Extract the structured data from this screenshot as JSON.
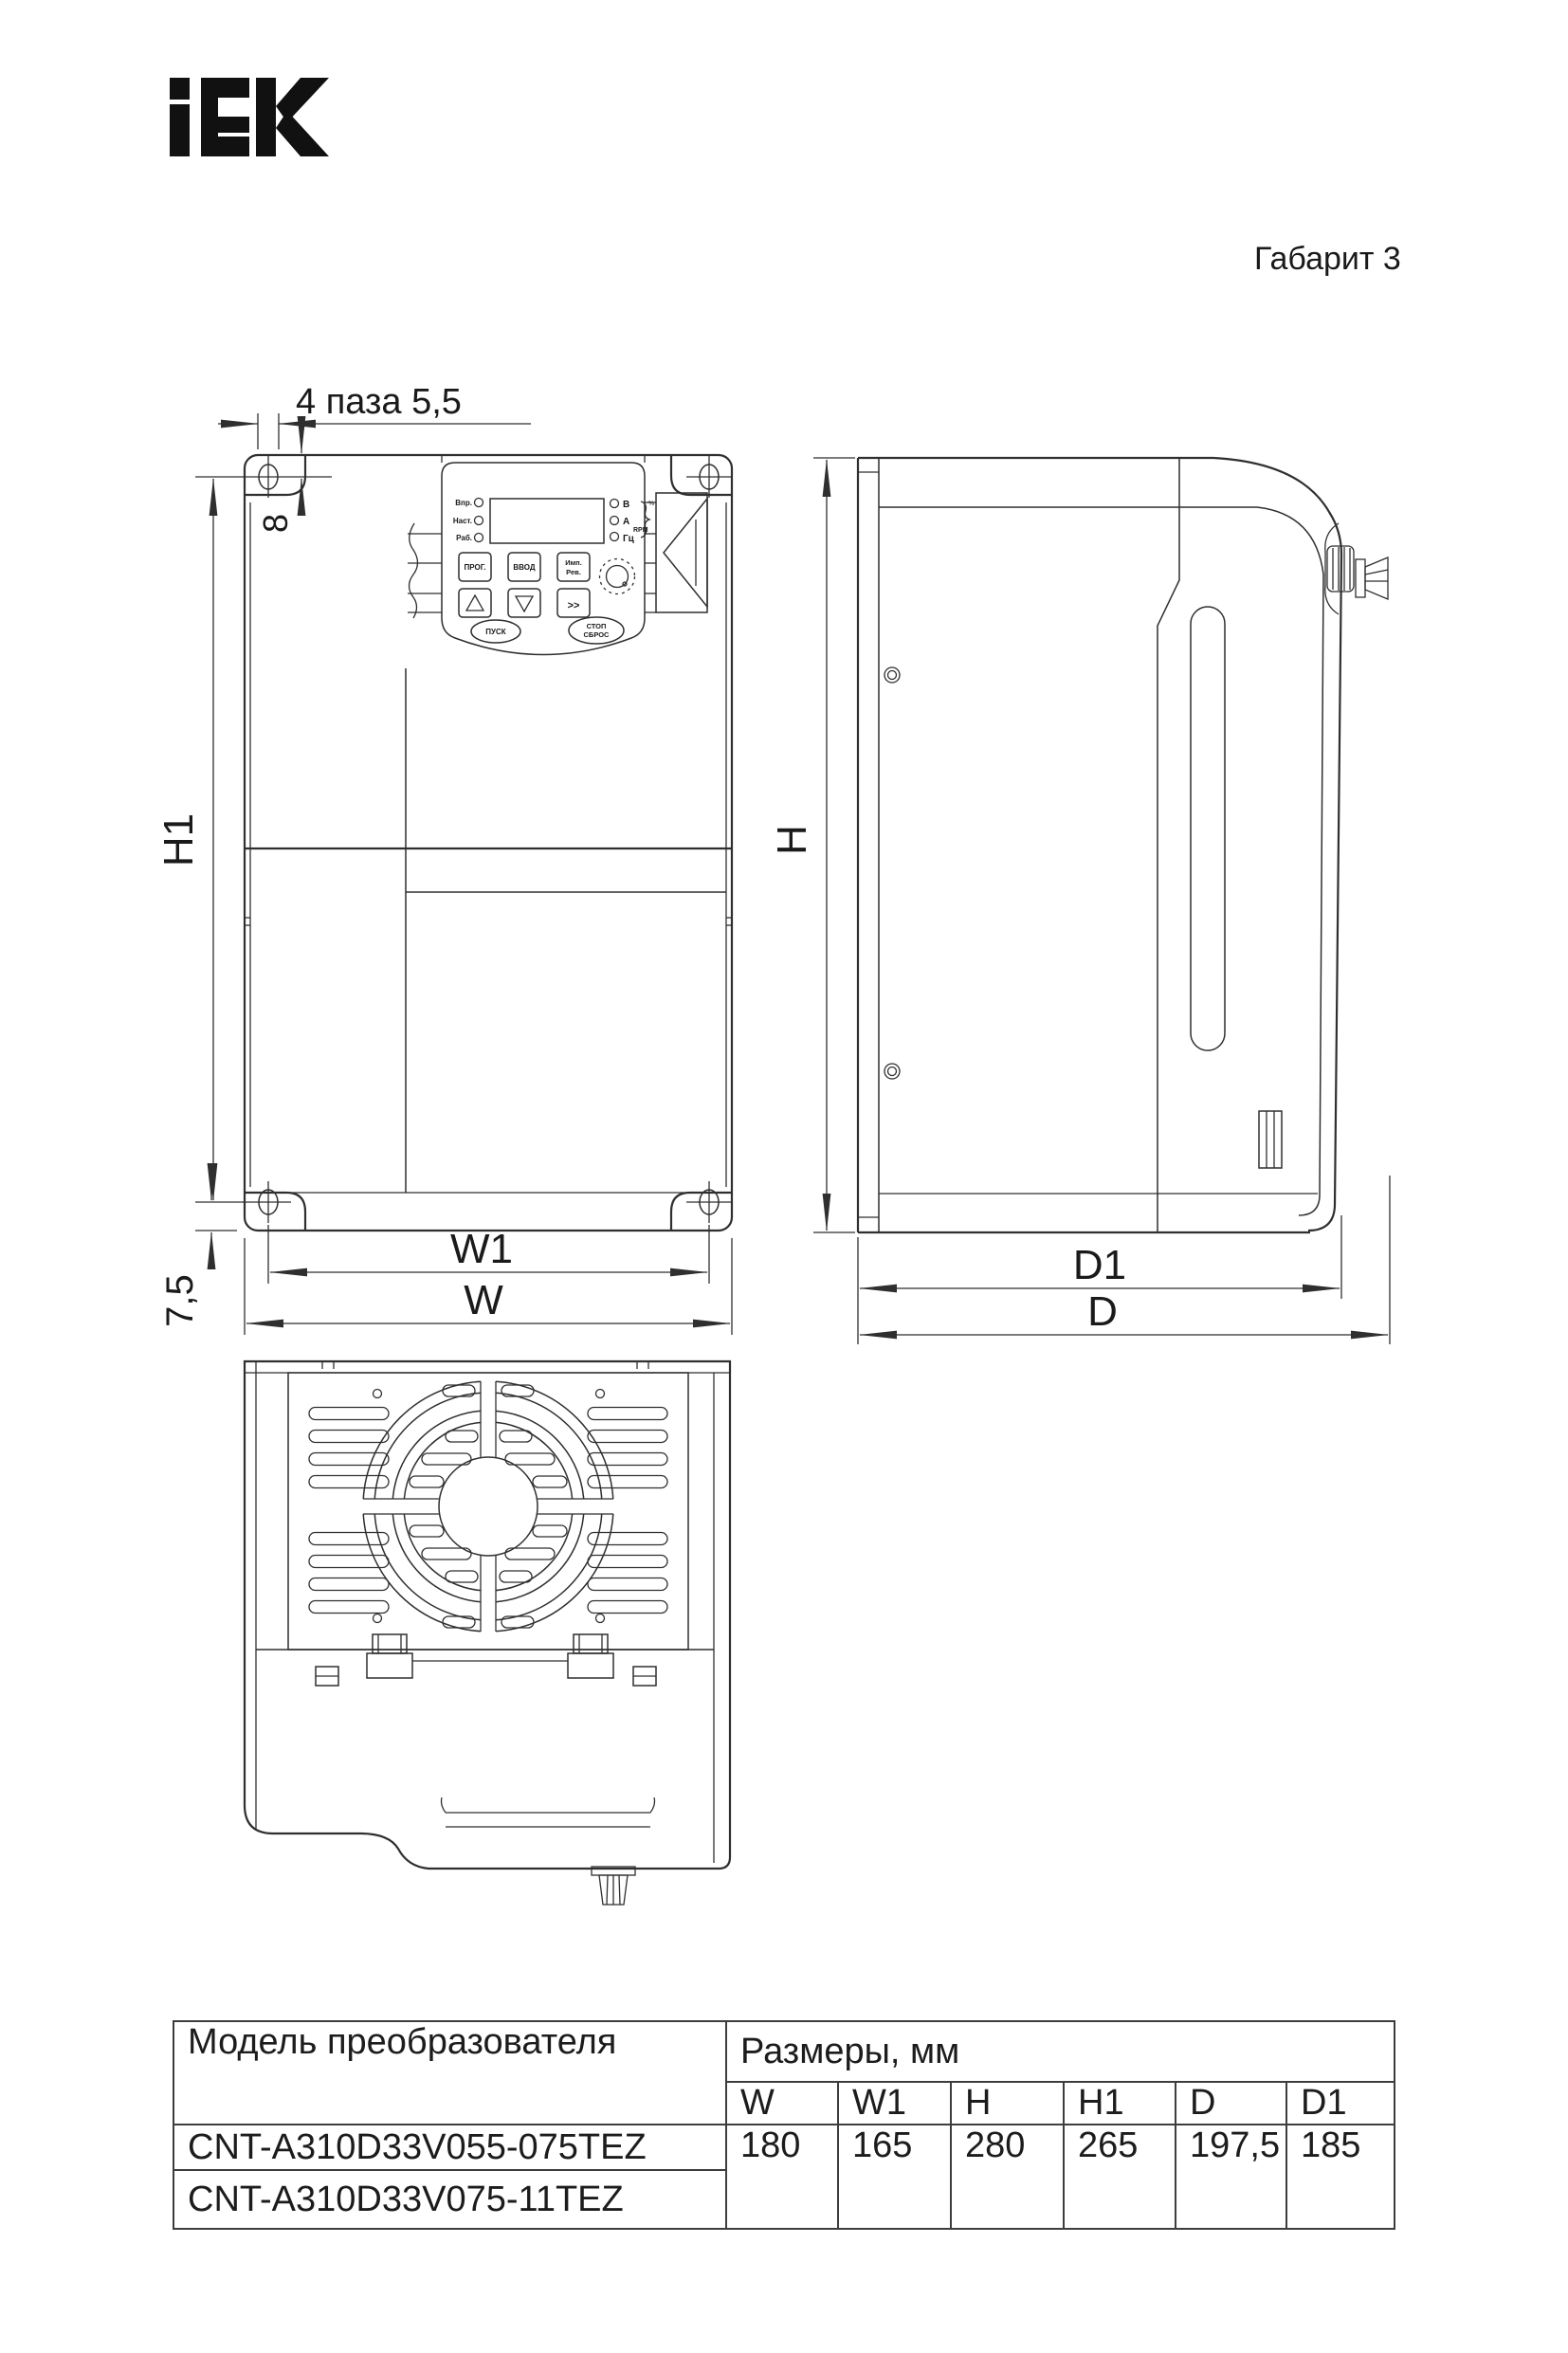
{
  "page": {
    "brand": "IEK",
    "variant_label": "Габарит 3"
  },
  "front_view": {
    "slots_label": "4 паза 5,5",
    "dim_8": "8",
    "dim_h1": "H1",
    "dim_7_5": "7,5",
    "dim_w1": "W1",
    "dim_w": "W",
    "keypad": {
      "led_labels_left": [
        "Впр.",
        "Наст.",
        "Раб."
      ],
      "led_labels_right": [
        "В",
        "А",
        "Гц"
      ],
      "percent_label": "%",
      "rpm_label": "RPM",
      "prog_button": "ПРОГ.",
      "enter_button": "ВВОД",
      "jog_button_line1": "Имп.",
      "jog_button_line2": "Рев.",
      "shift_button": ">>",
      "run_button": "ПУСК",
      "stop_button_line1": "СТОП",
      "stop_button_line2": "СБРОС"
    }
  },
  "side_view": {
    "dim_h": "H",
    "dim_d1": "D1",
    "dim_d": "D"
  },
  "table": {
    "model_header": "Модель преобразователя",
    "sizes_header": "Размеры, мм",
    "columns": [
      "W",
      "W1",
      "H",
      "H1",
      "D",
      "D1"
    ],
    "rows": [
      {
        "model": "CNT-A310D33V055-075TEZ"
      },
      {
        "model": "CNT-A310D33V075-11TEZ"
      }
    ],
    "values": [
      "180",
      "165",
      "280",
      "265",
      "197,5",
      "185"
    ]
  }
}
